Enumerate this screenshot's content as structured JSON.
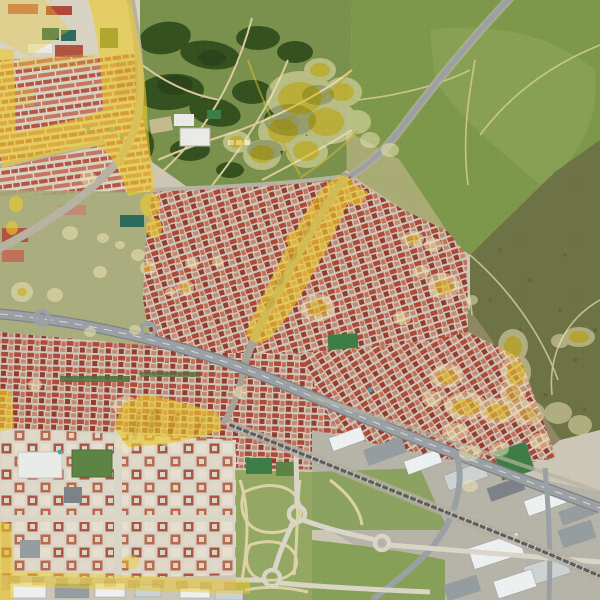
{
  "palette": {
    "base": "#ccc6b6",
    "grass": "#7d974b",
    "grass_bright": "#8aa355",
    "olive_dark": "#6d7344",
    "scrub_brown": "#897f5c",
    "scrub_speckle": "#5f5c3e",
    "park_green": "#7a914d",
    "tree_dark": "#35511f",
    "tree_darker": "#2a411b",
    "sand_path": "#d9cb9b",
    "sand_patch": "#c5b98f",
    "transition_green": "#a3a873",
    "street": "#cfc8b8",
    "roof_a": "#ad4a3a",
    "roof_b": "#c2705a",
    "roof_c": "#933d30",
    "roof_d": "#c08a76",
    "suburb_bg": "#d8d3c3",
    "suburb_row_a": "#b35644",
    "suburb_row_b": "#c4765e",
    "suburb_gap": "#e4dfd2",
    "grid_bg": "#d9d5c7",
    "grid_block_red": "#b05442",
    "grid_block_pale": "#e6dfd0",
    "grid_block_tan": "#e0d8c8",
    "grid_block_orange": "#b86a50",
    "ind_bg": "#b8b6ac",
    "ind_ground": "#b6b3a8",
    "ind_white": "#edf0f0",
    "ind_gray": "#969da1",
    "ind_light": "#ccd1d2",
    "ind_dark": "#7c8287",
    "np_green": "#94a763",
    "np_grass_e": "#87a058",
    "np_path": "#ddd2a6",
    "court_green": "#3e7d46",
    "court_teal": "#2e6a5c",
    "field_green": "#5d8444",
    "hedge_green": "#4c7038",
    "road_light": "#b7b2a2",
    "road_gray": "#9ba0a4",
    "road_casing": "#7e8287",
    "road_minor": "#a8a396",
    "rail_dark": "#5a5d5f",
    "rail_verge": "#b4ae9e",
    "white_bldg": "#e9ebe8",
    "pool_blue": "#4aa3ab",
    "grain_dark": "rgba(0,0,0,0.05)",
    "grain_light": "rgba(255,255,255,0.07)"
  },
  "overlay": {
    "highlight": "#ecca2a",
    "halo": "#eee4b4",
    "core": "#e0bd22",
    "speckle": "#cf9f12",
    "line": "#e3c430"
  }
}
